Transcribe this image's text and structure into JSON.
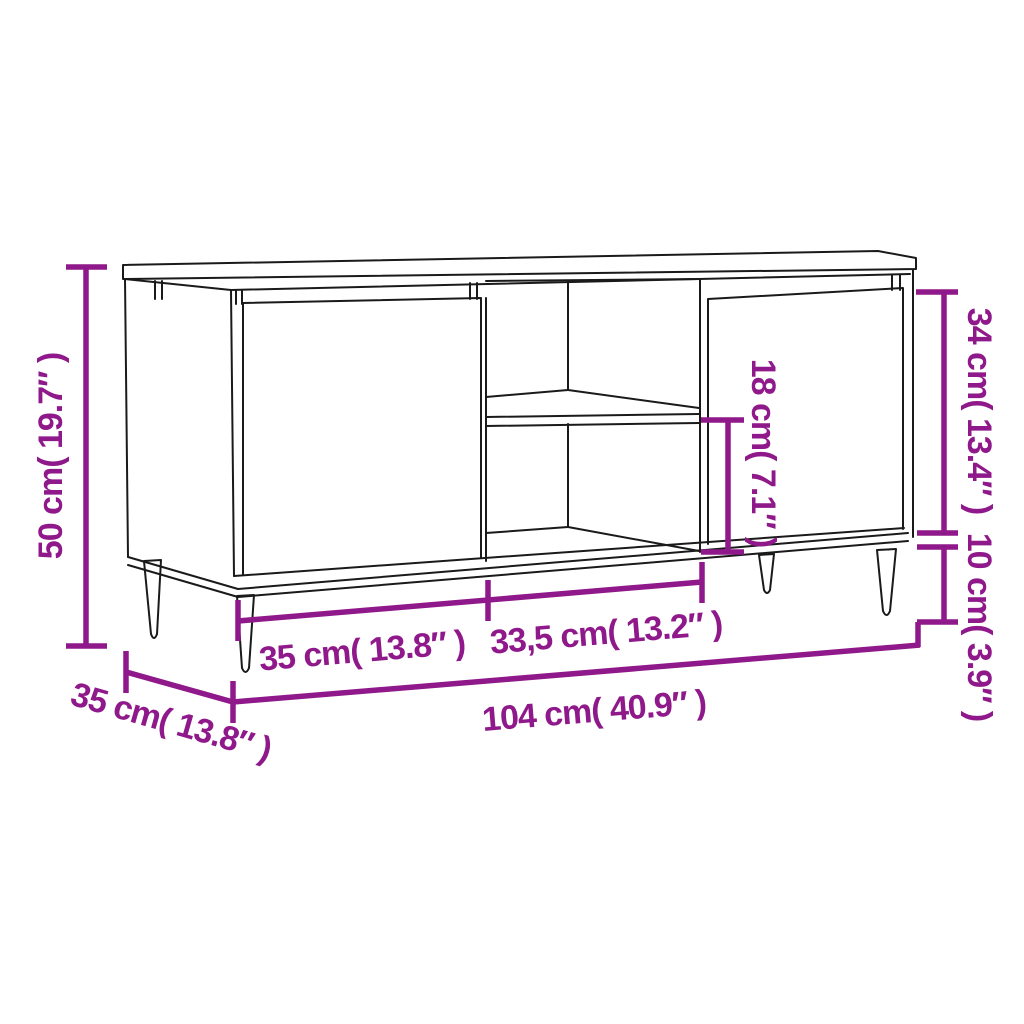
{
  "colors": {
    "accent": "#8F188A",
    "line": "#1A1A1A",
    "background": "#FFFFFF"
  },
  "dimensions": {
    "overall_height": {
      "label": "50 cm( 19.7″ )",
      "cm": "50",
      "inches": "19.7"
    },
    "depth": {
      "label": "35 cm( 13.8″ )",
      "cm": "35",
      "inches": "13.8"
    },
    "left_door_width": {
      "label": "35 cm( 13.8″ )",
      "cm": "35",
      "inches": "13.8"
    },
    "middle_section_width": {
      "label": "33,5 cm( 13.2″ )",
      "cm": "33,5",
      "inches": "13.2"
    },
    "overall_width": {
      "label": "104 cm( 40.9″ )",
      "cm": "104",
      "inches": "40.9"
    },
    "door_height": {
      "label": "34 cm( 13.4″ )",
      "cm": "34",
      "inches": "13.4"
    },
    "leg_height": {
      "label": "10 cm( 3.9″ )",
      "cm": "10",
      "inches": "3.9"
    },
    "shelf_opening_height": {
      "label": "18 cm( 7.1″ )",
      "cm": "18",
      "inches": "7.1"
    }
  }
}
